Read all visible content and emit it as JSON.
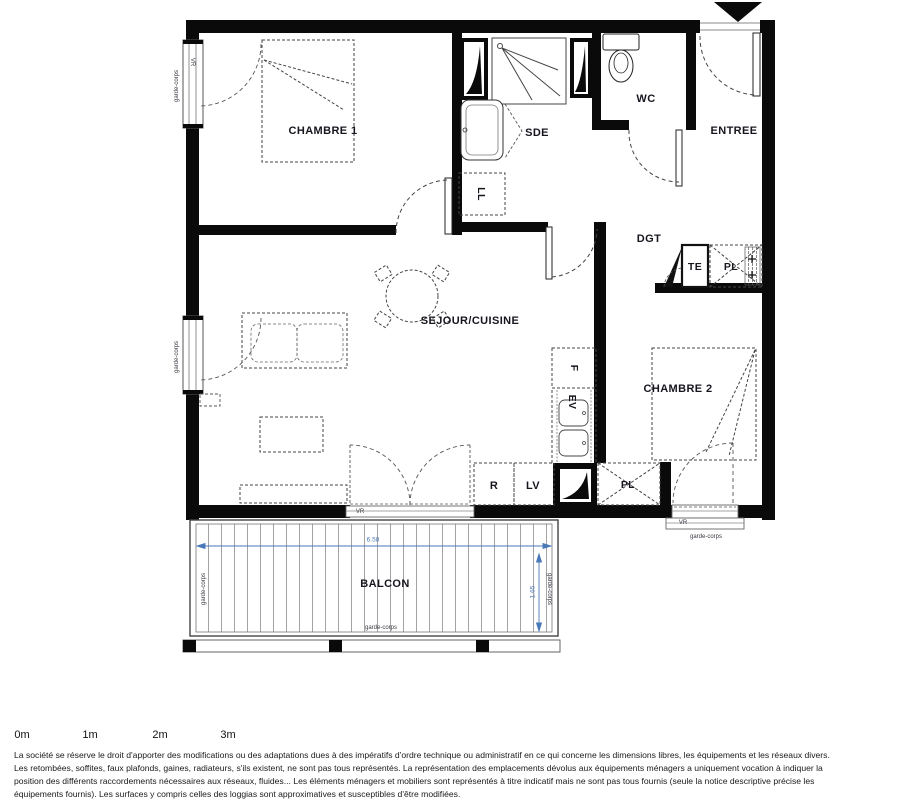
{
  "plan": {
    "rooms": {
      "chambre1": "CHAMBRE 1",
      "sde": "SDE",
      "wc": "WC",
      "entree": "ENTREE",
      "dgt": "DGT",
      "sejour": "SEJOUR/CUISINE",
      "chambre2": "CHAMBRE 2",
      "balcon": "BALCON"
    },
    "fixtures": {
      "te": "TE",
      "pl_upper": "PL",
      "pl_lower": "PL",
      "f": "F",
      "ev": "EV",
      "r": "R",
      "lv": "LV",
      "ll": "LL"
    },
    "small_labels": {
      "vr": "VR",
      "garde_corps": "garde-corps"
    },
    "dimensions": {
      "balcony_width": "6.58",
      "balcony_depth": "1.65"
    }
  },
  "scale_bar": {
    "labels": [
      "0m",
      "1m",
      "2m",
      "3m"
    ]
  },
  "disclaimer": {
    "line1": "La société se réserve le droit d'apporter des modifications ou des adaptations dues à des impératifs d'ordre technique ou administratif en ce qui concerne les dimensions libres, les équipements et les réseaux divers.",
    "line2": "Les retombées, soffites, faux plafonds, gaines, radiateurs, s'ils existent, ne sont pas tous représentés. La représentation des emplacements dévolus aux équipements ménagers a uniquement vocation à indiquer la",
    "line3": "position des différents raccordements nécessaires aux réseaux, fluides... Les éléments ménagers et mobiliers sont représentés à titre indicatif mais ne sont pas tous fournis (seule la notice descriptive précise les",
    "line4": "équipements fournis). Les surfaces y compris celles des loggias sont approximatives et susceptibles d'être modifiées."
  },
  "colors": {
    "wall": "#0a0a0a",
    "dimension_blue": "#4a79b8",
    "text": "#16161f"
  }
}
